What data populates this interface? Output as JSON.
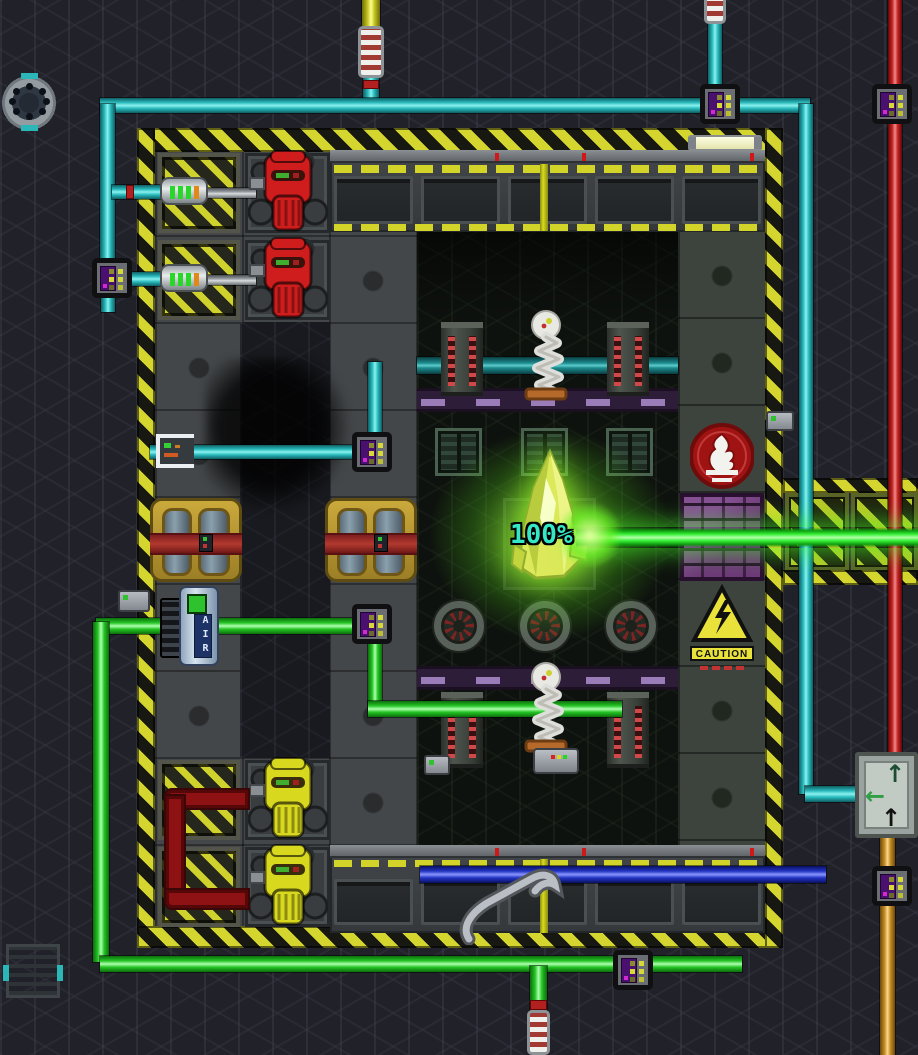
{
  "scene": {
    "type": "space-station-engine-room",
    "integrity_label": "100%",
    "air_canister_label": "AIR",
    "caution_sign_label": "CAUTION"
  },
  "icons": {
    "arrow_up": "↑",
    "arrow_left": "←",
    "flame_sign": "flame-hazard-icon",
    "lightning_sign": "electrical-hazard-icon"
  },
  "colors": {
    "background": "#212229",
    "hazard_yellow": "#d4d52e",
    "pipe_cyan": "#29b9bc",
    "pipe_green": "#24c424",
    "pipe_red": "#c22222",
    "pipe_dark_red": "#8e1113",
    "pipe_yellow": "#c2c222",
    "pipe_orange": "#c28a26",
    "pipe_blue": "#2233c2",
    "pipe_teal_dark": "#1b8a8d",
    "beam_green": "#39f039",
    "crystal_green": "#dce95a",
    "integrity_text": "#35e8c5",
    "purple_wall": "#6d3a78",
    "purple_strip": "#9a7cb8",
    "meter_screen": "#4a1070",
    "machine_red": "#cf1d1d",
    "machine_yellow": "#d8d81e",
    "circulator_gold": "#caa93c"
  },
  "counts": {
    "red_portable_machines": 2,
    "yellow_portable_machines": 2,
    "teg_circulators": 2,
    "tesla_coils": 4,
    "grounding_rods": 2,
    "fans": 3,
    "wall_vents": 3,
    "gas_meters": 7,
    "inline_gas_filters": 2
  }
}
